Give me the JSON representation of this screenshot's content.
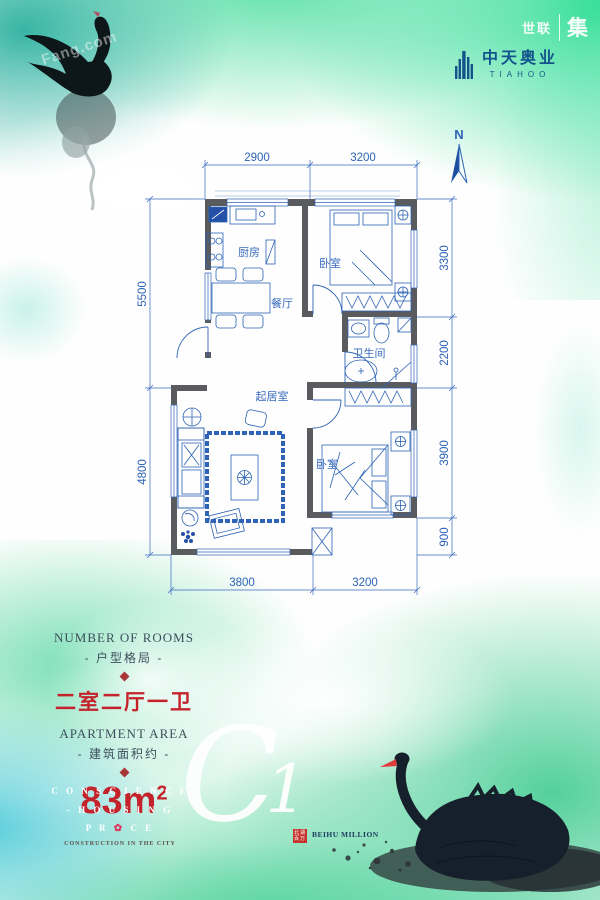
{
  "header": {
    "watermark_left": "世联",
    "watermark_right": "集",
    "logo_cn": "中天奥业",
    "logo_en": "TIAHOO"
  },
  "compass": {
    "label": "N"
  },
  "plan": {
    "rooms": {
      "kitchen": "厨房",
      "bedroom1": "卧室",
      "dining": "餐厅",
      "bath": "卫生间",
      "living": "起居室",
      "bedroom2": "卧室"
    },
    "dims": {
      "top": [
        "2900",
        "3200"
      ],
      "right": [
        "3300",
        "2200",
        "3900",
        "900"
      ],
      "left": [
        "5500",
        "4800"
      ],
      "bottom": [
        "3800",
        "3200"
      ]
    }
  },
  "info": {
    "rooms_title_en": "NUMBER OF ROOMS",
    "rooms_title_cn": "- 户型格局 -",
    "rooms_value": "二室二厅一卫",
    "area_title_en": "APARTMENT AREA",
    "area_title_cn": "- 建筑面积约 -",
    "area_value": "83m",
    "area_sup": "2"
  },
  "slogan": {
    "line1": "C O N S C I E N C E",
    "line2": "- H O U S I N G",
    "line3_pre": "P R",
    "line3_post": "C E",
    "line4": "CONSTRUCTION IN THE CITY"
  },
  "unit": {
    "c": "C",
    "one": "1"
  },
  "brand": {
    "seal_top": "北湖",
    "seal_bottom": "百万",
    "name": "BEIHU MILLION"
  },
  "watermark": {
    "fang": "Fang.com"
  },
  "colors": {
    "plan_blue": "#2e63b5",
    "wall_gray": "#595b5e",
    "accent_red": "#c5232b",
    "logo_navy": "#14538c",
    "bg_green": "#4ade9f",
    "bg_teal": "#28af9e"
  }
}
